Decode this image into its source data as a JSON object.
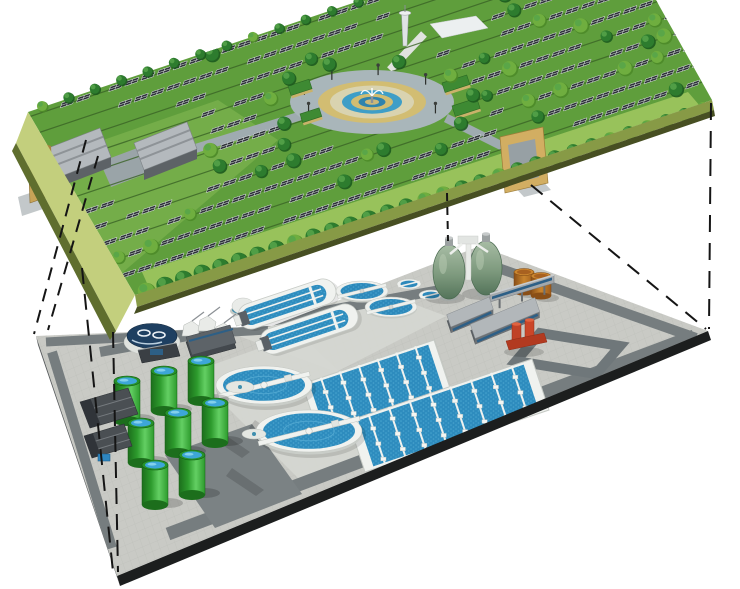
{
  "scene": {
    "canvas": {
      "w": 740,
      "h": 589,
      "background": "#ffffff"
    },
    "description": "cutaway-illustration-solar-park-built-above-underground-wastewater-treatment-plant",
    "palette": {
      "grass": "#5f9e3c",
      "grassLight": "#8abc55",
      "grassPale": "#a6ca63",
      "edgeFaceL": "#c3cf7d",
      "edgeLipL": "#5f6e2e",
      "edgeFaceR": "#879a46",
      "edgeLipR": "#474f22",
      "pave": "#c9cac5",
      "paveLine": "#bcbeb8",
      "road": "#767d7f",
      "roadDark": "#6f777a",
      "patch": "#7b8284",
      "apron": "#d5d7d2",
      "water": "#2e8cbe",
      "waterDeep": "#2d89bb",
      "waterLight": "#58b7dd",
      "white": "#f0f2ef",
      "whiteShade": "#c6cac5",
      "panel": "#2d3237",
      "panelLine": "#e2e6e9",
      "rowLine": "#3a6326",
      "tree": "#2d7c2e",
      "treeDark": "#1c5a1e",
      "treeLight": "#57a54a",
      "tan": "#d2bd72",
      "plazaRing": "#a9b6ba",
      "plazaDisc": "#d9d3b0",
      "hub": "#cdb878",
      "blueRing1": "#3e9ec7",
      "blueRing2": "#2f83ad",
      "shedRoof": "#b4b9bd",
      "shedFace": "#5d6266",
      "shedLine": "#888d91",
      "gateTan": "#c8a357",
      "gateTanDark": "#a5833f",
      "gateTanRight": "#d2ae62",
      "gateOpening": "#97a0a4",
      "ramp": "#c3c8ca",
      "towerFill": "#dfe3e5",
      "tankGreenDark": "#156015",
      "tankTop": "#27922a",
      "tankWater": "#3da6d8",
      "tankGlint": "#8ed7f0",
      "digester": "#7e9a7e",
      "digesterDark": "#4a6a50",
      "fuelDark": "#7a4512",
      "fuelMid": "#b06c24",
      "fuelLight": "#c9852f",
      "red": "#c04227",
      "redDark": "#8f2d18",
      "redLight": "#e06240",
      "navy": "#1e3f61",
      "steel": "#a3a8ac",
      "steelDark": "#43484d",
      "windows": "#2d5f86",
      "dash": "#151515"
    },
    "upper": {
      "surface": [
        [
          28,
          112
        ],
        [
          362,
          0
        ],
        [
          656,
          0
        ],
        [
          712,
          100
        ],
        [
          135,
          295
        ]
      ],
      "faces": {
        "left": [
          [
            28,
            112
          ],
          [
            135,
            295
          ],
          [
            116,
            331
          ],
          [
            16,
            143
          ]
        ],
        "leftLip": [
          [
            16,
            143
          ],
          [
            116,
            331
          ],
          [
            110,
            340
          ],
          [
            12,
            151
          ]
        ],
        "right": [
          [
            135,
            295
          ],
          [
            712,
            100
          ],
          [
            714,
            110
          ],
          [
            137,
            307
          ]
        ],
        "rightLip": [
          [
            137,
            307
          ],
          [
            714,
            110
          ],
          [
            715,
            116
          ],
          [
            134,
            314
          ]
        ]
      },
      "axes": {
        "u": [
          0.948,
          -0.318
        ],
        "w": [
          -0.505,
          -0.863
        ],
        "anchor": [
          135,
          295
        ]
      },
      "field": {
        "rows": 12,
        "first": 22,
        "spacing": 18.5,
        "step": 17,
        "tRange": [
          -30,
          640
        ],
        "treeChance": 0.13,
        "gapChance": 0.1
      },
      "exclusions": {
        "ellipse": {
          "cx": 372,
          "cy": 102,
          "rx": 112,
          "ry": 48
        },
        "boxes": [
          [
            28,
            106,
            206,
            202
          ],
          [
            16,
            130,
            64,
            220
          ],
          [
            490,
            120,
            568,
            204
          ],
          [
            390,
            0,
            494,
            54
          ]
        ]
      },
      "patches": [
        {
          "pts": [
            [
              150,
              290
            ],
            [
              700,
              106
            ],
            [
              688,
              92
            ],
            [
              142,
              272
            ]
          ],
          "fill": "#a6ca63",
          "op": 0.8
        },
        {
          "pts": [
            [
              40,
              162
            ],
            [
              218,
              100
            ],
            [
              278,
              140
            ],
            [
              102,
              290
            ]
          ],
          "fill": "#8abc55",
          "op": 0.5
        }
      ],
      "paths": [
        {
          "from": [
            300,
            116
          ],
          "to": [
            152,
            162
          ],
          "w": 9,
          "color": "#9fabb0"
        },
        {
          "from": [
            446,
            118
          ],
          "to": [
            514,
            152
          ],
          "w": 9,
          "color": "#9fabb0"
        },
        {
          "from": [
            390,
            70
          ],
          "to": [
            424,
            34
          ],
          "w": 8,
          "color": "#e0e3df"
        }
      ],
      "courtyard": [
        [
          100,
          162
        ],
        [
          140,
          147
        ],
        [
          151,
          172
        ],
        [
          111,
          187
        ]
      ],
      "plaza": {
        "cx": 372,
        "cy": 102,
        "rings": [
          {
            "rx": 82,
            "ry": 32,
            "f": "#a9b6ba"
          },
          {
            "rx": 54,
            "ry": 21,
            "f": "#d2bd72"
          },
          {
            "rx": 42,
            "ry": 16.5,
            "f": "#d9d3b0"
          },
          {
            "rx": 30,
            "ry": 11.7,
            "f": "#3e9ec7"
          },
          {
            "rx": 21,
            "ry": 8.2,
            "f": "#d2bd72"
          },
          {
            "rx": 13.5,
            "ry": 5.3,
            "f": "#2f83ad"
          },
          {
            "rx": 7,
            "ry": 2.8,
            "f": "#cdb878"
          }
        ],
        "lampAngles": [
          155,
          195,
          235,
          275,
          320,
          25
        ],
        "lampR": [
          70,
          27
        ]
      },
      "hedges": [
        [
          288,
          86,
          22,
          10
        ],
        [
          300,
          114,
          20,
          9
        ],
        [
          442,
          83,
          26,
          10
        ],
        [
          452,
          106,
          26,
          11
        ]
      ],
      "hedgeRot": -18,
      "sheds": [
        {
          "roof": [
            [
              43,
              150
            ],
            [
              100,
              128
            ],
            [
              111,
              157
            ],
            [
              54,
              179
            ]
          ],
          "face": [
            [
              54,
              179
            ],
            [
              111,
              157
            ],
            [
              111,
              167
            ],
            [
              54,
              189
            ]
          ]
        },
        {
          "roof": [
            [
              134,
              143
            ],
            [
              187,
              122
            ],
            [
              197,
              149
            ],
            [
              144,
              170
            ]
          ],
          "face": [
            [
              144,
              170
            ],
            [
              197,
              149
            ],
            [
              197,
              159
            ],
            [
              144,
              180
            ]
          ]
        }
      ],
      "gates": {
        "left": {
          "front": [
            [
              28,
              150
            ],
            [
              45,
              144
            ],
            [
              47,
              197
            ],
            [
              30,
              203
            ]
          ],
          "side": [
            [
              45,
              144
            ],
            [
              51,
              146
            ],
            [
              53,
              195
            ],
            [
              47,
              197
            ]
          ],
          "ramp": [
            [
              18,
              197
            ],
            [
              42,
              189
            ],
            [
              46,
              208
            ],
            [
              22,
              216
            ]
          ]
        },
        "right": {
          "frame": [
            [
              500,
              137
            ],
            [
              543,
              127
            ],
            [
              548,
              183
            ],
            [
              505,
              193
            ]
          ],
          "opening": [
            [
              508,
              145
            ],
            [
              535,
              139
            ],
            [
              539,
              177
            ],
            [
              512,
              184
            ]
          ],
          "ramp": [
            [
              512,
              184
            ],
            [
              539,
              177
            ],
            [
              551,
              190
            ],
            [
              524,
              197
            ]
          ]
        }
      },
      "tower": {
        "x": 405,
        "baseY": 46,
        "topY": 14,
        "capRx": 6
      },
      "towerBuilding": [
        [
          430,
          24
        ],
        [
          476,
          16
        ],
        [
          488,
          28
        ],
        [
          442,
          38
        ]
      ],
      "edgeTrees": {
        "from": [
          146,
          291
        ],
        "to": [
          703,
          108
        ],
        "step": 19,
        "r0": 9,
        "r1": 6.5
      },
      "backTrees": {
        "from": [
          42,
          106
        ],
        "to": [
          358,
          2
        ],
        "step": 26,
        "r0": 5.5,
        "r1": 5
      },
      "plazaTrees": {
        "rx": 102,
        "ry": 42,
        "angles": [
          150,
          185,
          215,
          245,
          285,
          320,
          350,
          30
        ]
      }
    },
    "lower": {
      "surface": [
        [
          36,
          336
        ],
        [
          272,
          326
        ],
        [
          480,
          246
        ],
        [
          708,
          331
        ],
        [
          117,
          576
        ]
      ],
      "faces": {
        "front": [
          [
            117,
            576
          ],
          [
            708,
            331
          ],
          [
            711,
            340
          ],
          [
            120,
            586
          ]
        ],
        "left": [
          [
            36,
            336
          ],
          [
            117,
            576
          ],
          [
            120,
            586
          ],
          [
            38,
            345
          ]
        ]
      },
      "axes": {
        "u": [
          0.923,
          -0.383
        ],
        "v": [
          0.32,
          0.949
        ]
      },
      "roads": [
        {
          "from": [
            168,
            534
          ],
          "to": [
            694,
            336
          ],
          "w": 13
        },
        {
          "from": [
            52,
            352
          ],
          "to": [
            112,
            548
          ],
          "w": 10
        },
        {
          "from": [
            46,
            342
          ],
          "to": [
            268,
            330
          ],
          "w": 9
        },
        {
          "from": [
            470,
            258
          ],
          "to": [
            696,
            338
          ],
          "w": 10
        },
        {
          "from": [
            100,
            352
          ],
          "to": [
            440,
            290
          ],
          "w": 10
        }
      ],
      "loop": [
        [
          540,
          333
        ],
        [
          620,
          346
        ],
        [
          596,
          374
        ],
        [
          516,
          361
        ]
      ],
      "darkPatch": [
        [
          165,
          455
        ],
        [
          252,
          424
        ],
        [
          302,
          494
        ],
        [
          215,
          528
        ]
      ],
      "aprons": [
        [
          [
            192,
            372
          ],
          [
            300,
            334
          ],
          [
            410,
            440
          ],
          [
            300,
            480
          ]
        ],
        [
          [
            228,
            332
          ],
          [
            338,
            276
          ],
          [
            446,
            316
          ],
          [
            336,
            372
          ]
        ]
      ],
      "tankShadows": [
        [
          218,
          430
        ],
        [
          255,
          420
        ],
        [
          232,
          468
        ]
      ],
      "greenTanks": [
        [
          127,
          381
        ],
        [
          164,
          371
        ],
        [
          201,
          361
        ],
        [
          141,
          423
        ],
        [
          178,
          413
        ],
        [
          215,
          403
        ],
        [
          155,
          465
        ],
        [
          192,
          455
        ]
      ],
      "tankSize": {
        "rx": 13,
        "h": 40,
        "topRy": 5
      },
      "pads": [
        [
          240,
          387,
          14,
          6
        ],
        [
          254,
          434,
          12,
          5
        ]
      ],
      "clarifiers": [
        {
          "cx": 264,
          "cy": 385,
          "rx": 48,
          "ry": 19
        },
        {
          "cx": 309,
          "cy": 431,
          "rx": 53,
          "ry": 21
        }
      ],
      "bridgeRot": -14,
      "basins": [
        {
          "pts": [
            [
              302,
              384
            ],
            [
              434,
              340
            ],
            [
              451,
              391
            ],
            [
              319,
              435
            ]
          ],
          "div": 6
        },
        {
          "pts": [
            [
              348,
              421
            ],
            [
              532,
              359
            ],
            [
              549,
              410
            ],
            [
              365,
              472
            ]
          ],
          "div": 8
        }
      ],
      "ditches": [
        {
          "cx": 287,
          "cy": 304
        },
        {
          "cx": 309,
          "cy": 329
        }
      ],
      "ditchSize": {
        "len": 102,
        "wid": 26,
        "rot": -18.5
      },
      "smallClarifiers": [
        {
          "cx": 362,
          "cy": 291,
          "rx": 26,
          "ry": 10
        },
        {
          "cx": 391,
          "cy": 307,
          "rx": 26,
          "ry": 10
        }
      ],
      "thickeners": [
        {
          "cx": 409,
          "cy": 284,
          "rx": 12,
          "ry": 5
        },
        {
          "cx": 431,
          "cy": 295,
          "rx": 12,
          "ry": 5
        }
      ],
      "digesters": [
        {
          "cx": 449,
          "cy": 272
        },
        {
          "cx": 486,
          "cy": 268
        }
      ],
      "digSize": {
        "rx": 16,
        "ry": 27
      },
      "digPlatform": {
        "col": [
          466,
          242,
          5,
          38
        ],
        "top": [
          458,
          236,
          20,
          8
        ]
      },
      "fuelTanks": [
        {
          "cx": 524,
          "cy": 282
        },
        {
          "cx": 541,
          "cy": 286
        }
      ],
      "fuelSize": {
        "rx": 10,
        "h": 20,
        "ry": 3.5
      },
      "conveyor": {
        "from": [
          490,
          302
        ],
        "to": [
          554,
          283
        ],
        "h": 8
      },
      "buildings": [
        {
          "c": [
            470,
            318
          ],
          "len": 46,
          "wid": 13
        },
        {
          "c": [
            505,
            324
          ],
          "len": 70,
          "wid": 15
        }
      ],
      "redUnit": {
        "x": 520,
        "y": 338
      },
      "navyTank": {
        "cx": 152,
        "cy": 336,
        "rx": 25,
        "ry": 12.5
      },
      "controlBox": [
        [
          138,
          350
        ],
        [
          176,
          343
        ],
        [
          180,
          356
        ],
        [
          142,
          363
        ]
      ],
      "machines": [
        [
          190,
          330
        ],
        [
          206,
          325
        ],
        [
          222,
          332
        ]
      ],
      "darkBuilding": [
        [
          186,
          342
        ],
        [
          230,
          330
        ],
        [
          236,
          348
        ],
        [
          192,
          360
        ]
      ],
      "trucks": [
        [
          [
            80,
            402
          ],
          [
            128,
            388
          ],
          [
            138,
            414
          ],
          [
            90,
            428
          ]
        ],
        [
          [
            84,
            436
          ],
          [
            124,
            424
          ],
          [
            132,
            446
          ],
          [
            92,
            458
          ]
        ]
      ],
      "pallet": [
        98,
        454,
        12,
        7
      ],
      "dome": {
        "cx": 243,
        "cy": 307
      }
    },
    "projections": [
      {
        "x1": 86,
        "y1": 140,
        "x2": 34,
        "y2": 334,
        "dash": "13 9"
      },
      {
        "x1": 98,
        "y1": 156,
        "x2": 48,
        "y2": 330,
        "dash": "13 9"
      },
      {
        "x1": 82,
        "y1": 268,
        "x2": 113,
        "y2": 572,
        "dash": "16 10"
      },
      {
        "x1": 113,
        "y1": 332,
        "x2": 118,
        "y2": 572,
        "dash": "16 10"
      },
      {
        "x1": 711,
        "y1": 103,
        "x2": 709,
        "y2": 329,
        "dash": "17 11"
      },
      {
        "x1": 531,
        "y1": 185,
        "x2": 706,
        "y2": 329,
        "dash": "15 10"
      },
      {
        "x1": 447,
        "y1": 193,
        "x2": 448,
        "y2": 241,
        "dash": "8 6"
      }
    ]
  }
}
